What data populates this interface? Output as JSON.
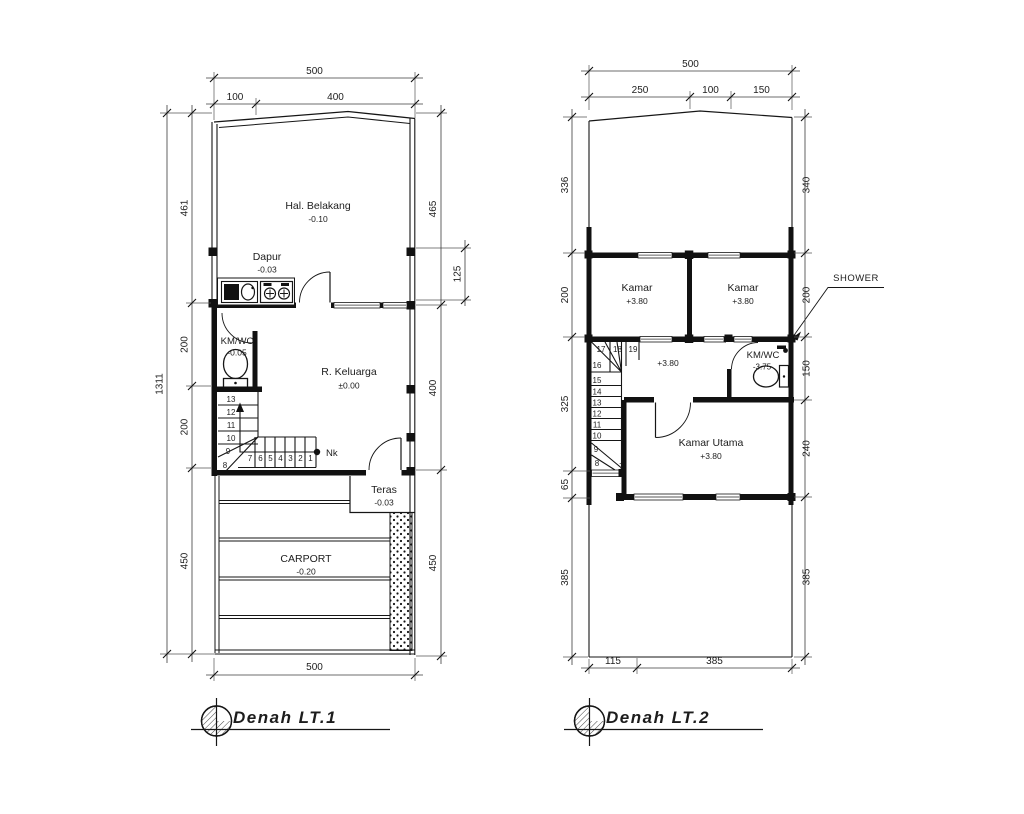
{
  "drawing": {
    "background": "#ffffff",
    "line_color": "#161616",
    "window_accent": "#8f8f8f"
  },
  "plans": {
    "lt1": {
      "title": "Denah LT.1",
      "dims": {
        "top_total": "500",
        "top_segments": [
          "100",
          "400"
        ],
        "left_total": "1311",
        "left_segments": [
          "461",
          "200",
          "200",
          "450"
        ],
        "right_segments": [
          "465",
          "125",
          "400",
          "450"
        ],
        "bottom_total": "500"
      },
      "rooms": {
        "hal_belakang": {
          "name": "Hal. Belakang",
          "level": "-0.10"
        },
        "dapur": {
          "name": "Dapur",
          "level": "-0.03"
        },
        "kmwc": {
          "name": "KM/WC",
          "level": "-0.05"
        },
        "r_keluarga": {
          "name": "R. Keluarga",
          "level": "±0.00"
        },
        "teras": {
          "name": "Teras",
          "level": "-0.03"
        },
        "carport": {
          "name": "CARPORT",
          "level": "-0.20"
        }
      },
      "annotations": {
        "nok": "Nk"
      },
      "stair_numbers": [
        "13",
        "12",
        "11",
        "10",
        "9",
        "8",
        "7",
        "6",
        "5",
        "4",
        "3",
        "2",
        "1"
      ]
    },
    "lt2": {
      "title": "Denah LT.2",
      "dims": {
        "top_total": "500",
        "top_segments": [
          "250",
          "100",
          "150"
        ],
        "left_segments": [
          "336",
          "200",
          "325",
          "65",
          "385"
        ],
        "right_segments": [
          "340",
          "200",
          "150",
          "240",
          "385"
        ],
        "bottom_segments": [
          "115",
          "385"
        ]
      },
      "rooms": {
        "kamar1": {
          "name": "Kamar",
          "level": "+3.80"
        },
        "kamar2": {
          "name": "Kamar",
          "level": "+3.80"
        },
        "hall_level": "+3.80",
        "kmwc": {
          "name": "KM/WC",
          "level": "-3.75"
        },
        "kamar_utama": {
          "name": "Kamar Utama",
          "level": "+3.80"
        }
      },
      "annotations": {
        "shower": "SHOWER"
      },
      "stair_numbers": [
        "17",
        "18",
        "19",
        "16",
        "15",
        "14",
        "13",
        "12",
        "11",
        "10",
        "9",
        "8",
        "7"
      ]
    }
  }
}
